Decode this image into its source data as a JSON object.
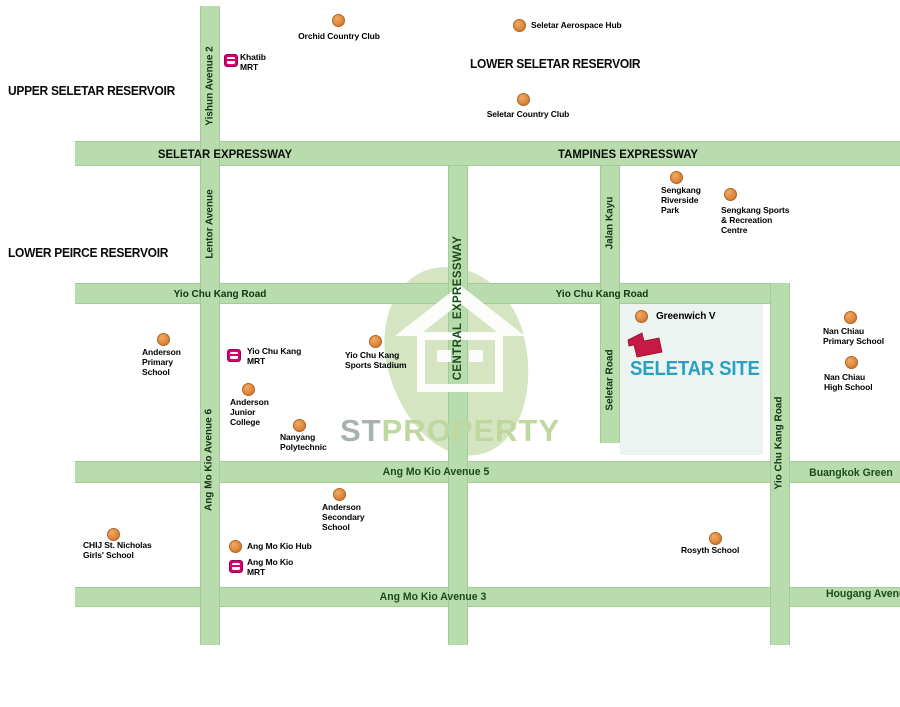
{
  "map": {
    "reservoirs": {
      "upper_seletar": "UPPER SELETAR RESERVOIR",
      "lower_seletar": "LOWER SELETAR RESERVOIR",
      "lower_peirce": "LOWER PEIRCE RESERVOIR"
    },
    "roads": {
      "seletar_expressway": "SELETAR EXPRESSWAY",
      "tampines_expressway": "TAMPINES EXPRESSWAY",
      "yio_chu_kang_road_west": "Yio Chu Kang Road",
      "yio_chu_kang_road_east": "Yio Chu Kang Road",
      "ang_mo_kio_avenue_5": "Ang Mo Kio Avenue 5",
      "ang_mo_kio_avenue_3": "Ang Mo Kio Avenue 3",
      "buangkok_green": "Buangkok Green",
      "hougang_avenue": "Hougang Avenue",
      "yishun_avenue_2": "Yishun Avenue 2",
      "lentor_avenue": "Lentor Avenue",
      "ang_mo_kio_avenue_6": "Ang Mo Kio Avenue 6",
      "central_expressway": "CENTRAL EXPRESSWAY",
      "jalan_kayu": "Jalan Kayu",
      "seletar_road": "Seletar Road",
      "yio_chu_kang_road_south": "Yio Chu Kang Road"
    },
    "site": {
      "label": "SELETAR SITE"
    },
    "pois": {
      "orchid_country_club": "Orchid Country Club",
      "seletar_aerospace_hub": "Seletar Aerospace Hub",
      "seletar_country_club": "Seletar Country Club",
      "sengkang_riverside_park": "Sengkang\nRiverside\nPark",
      "sengkang_sports_recreation_centre": "Sengkang Sports\n& Recreation\nCentre",
      "greenwich_v": "Greenwich V",
      "nan_chiau_primary_school": "Nan Chiau\nPrimary School",
      "nan_chiau_high_school": "Nan Chiau\nHigh School",
      "anderson_primary_school": "Anderson\nPrimary\nSchool",
      "yio_chu_kang_sports_stadium": "Yio Chu Kang\nSports Stadium",
      "anderson_junior_college": "Anderson\nJunior\nCollege",
      "nanyang_polytechnic": "Nanyang\nPolytechnic",
      "anderson_secondary_school": "Anderson\nSecondary\nSchool",
      "chij_st_nicholas_girls_school": "CHIJ St. Nicholas\nGirls' School",
      "ang_mo_kio_hub": "Ang Mo Kio Hub",
      "rosyth_school": "Rosyth School"
    },
    "mrt": {
      "khatib": "Khatib\nMRT",
      "yio_chu_kang": "Yio Chu Kang\nMRT",
      "ang_mo_kio": "Ang Mo Kio\nMRT"
    },
    "watermark": {
      "st": "ST",
      "property": "PROPERTY"
    },
    "colors": {
      "road_green": "#b9dcae",
      "road_edge": "#a3cd97",
      "poi_orange": "#dd8a3e",
      "mrt_magenta": "#d6006e",
      "site_marker_red": "#c41a44",
      "site_label_teal": "#2b9fbe",
      "watermark_gray": "#a9b3ae",
      "watermark_green": "#bed8a0"
    }
  }
}
